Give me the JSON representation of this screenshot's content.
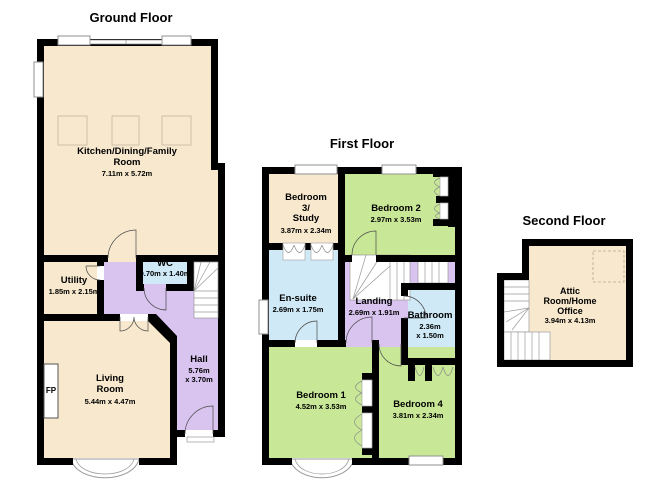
{
  "colors": {
    "wall": "#000000",
    "cream": "#f8e9ce",
    "green": "#c8e897",
    "purple": "#d9c3ef",
    "blue": "#cfe9f6",
    "window_stroke": "#8f8f8f"
  },
  "floors": {
    "ground": {
      "title": "Ground Floor",
      "rooms": {
        "kitchen": {
          "name": "Kitchen/Dining/Family\nRoom",
          "dims": "7.11m x 5.72m"
        },
        "utility": {
          "name": "Utility",
          "dims": "1.85m x 2.15m"
        },
        "wc": {
          "name": "WC",
          "dims": "0.70m x 1.40m"
        },
        "hall": {
          "name": "Hall",
          "dims": "5.76m\nx 3.70m"
        },
        "living": {
          "name": "Living\nRoom",
          "dims": "5.44m x 4.47m"
        },
        "fireplace": {
          "name": "FP"
        }
      }
    },
    "first": {
      "title": "First Floor",
      "rooms": {
        "bedroom3": {
          "name": "Bedroom\n3/\nStudy",
          "dims": "3.87m x 2.34m"
        },
        "bedroom2": {
          "name": "Bedroom 2",
          "dims": "2.97m x 3.53m"
        },
        "ensuite": {
          "name": "En-suite",
          "dims": "2.69m x 1.75m"
        },
        "landing": {
          "name": "Landing",
          "dims": "2.69m x 1.91m"
        },
        "bathroom": {
          "name": "Bathroom",
          "dims": "2.36m\nx 1.50m"
        },
        "bedroom1": {
          "name": "Bedroom 1",
          "dims": "4.52m x 3.53m"
        },
        "bedroom4": {
          "name": "Bedroom 4",
          "dims": "3.81m x 2.34m"
        }
      }
    },
    "second": {
      "title": "Second Floor",
      "rooms": {
        "attic": {
          "name": "Attic\nRoom/Home\nOffice",
          "dims": "3.94m x 4.13m"
        }
      }
    }
  }
}
